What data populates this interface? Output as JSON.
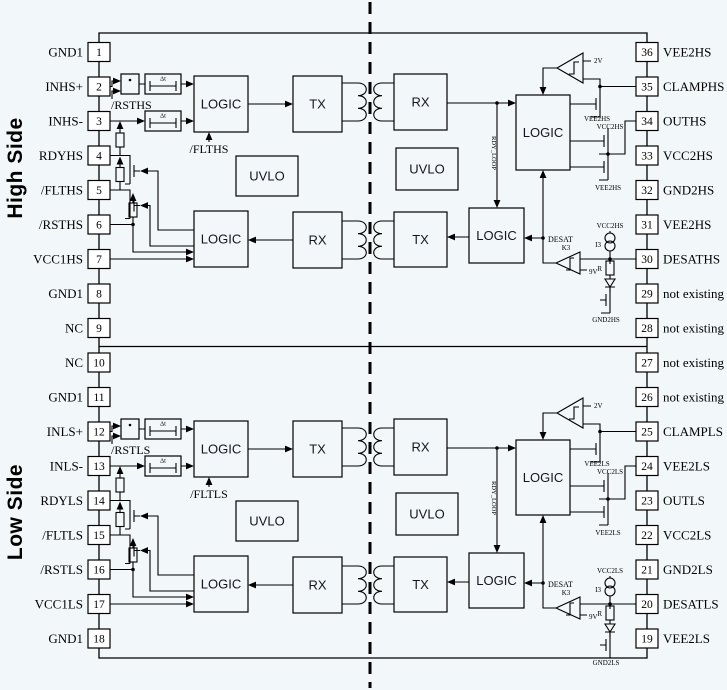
{
  "side_labels": {
    "high": "High Side",
    "low": "Low Side"
  },
  "pins_left": [
    {
      "num": "1",
      "label": "GND1"
    },
    {
      "num": "2",
      "label": "INHS+"
    },
    {
      "num": "3",
      "label": "INHS-"
    },
    {
      "num": "4",
      "label": "RDYHS"
    },
    {
      "num": "5",
      "label": "/FLTHS"
    },
    {
      "num": "6",
      "label": "/RSTHS"
    },
    {
      "num": "7",
      "label": "VCC1HS"
    },
    {
      "num": "8",
      "label": "GND1"
    },
    {
      "num": "9",
      "label": "NC"
    },
    {
      "num": "10",
      "label": "NC"
    },
    {
      "num": "11",
      "label": "GND1"
    },
    {
      "num": "12",
      "label": "INLS+"
    },
    {
      "num": "13",
      "label": "INLS-"
    },
    {
      "num": "14",
      "label": "RDYLS"
    },
    {
      "num": "15",
      "label": "/FLTLS"
    },
    {
      "num": "16",
      "label": "/RSTLS"
    },
    {
      "num": "17",
      "label": "VCC1LS"
    },
    {
      "num": "18",
      "label": "GND1"
    }
  ],
  "pins_right": [
    {
      "num": "36",
      "label": "VEE2HS"
    },
    {
      "num": "35",
      "label": "CLAMPHS"
    },
    {
      "num": "34",
      "label": "OUTHS"
    },
    {
      "num": "33",
      "label": "VCC2HS"
    },
    {
      "num": "32",
      "label": "GND2HS"
    },
    {
      "num": "31",
      "label": "VEE2HS"
    },
    {
      "num": "30",
      "label": "DESATHS"
    },
    {
      "num": "29",
      "label": "not existing"
    },
    {
      "num": "28",
      "label": "not existing"
    },
    {
      "num": "27",
      "label": "not existing"
    },
    {
      "num": "26",
      "label": "not existing"
    },
    {
      "num": "25",
      "label": "CLAMPLS"
    },
    {
      "num": "24",
      "label": "VEE2LS"
    },
    {
      "num": "23",
      "label": "OUTLS"
    },
    {
      "num": "22",
      "label": "VCC2LS"
    },
    {
      "num": "21",
      "label": "GND2LS"
    },
    {
      "num": "20",
      "label": "DESATLS"
    },
    {
      "num": "19",
      "label": "VEE2LS"
    }
  ],
  "halves": [
    {
      "name": "high-side",
      "blocks": {
        "logic_in": "LOGIC",
        "tx_top": "TX",
        "rx_top": "RX",
        "uvlo_left": "UVLO",
        "uvlo_right": "UVLO",
        "logic_fault": "LOGIC",
        "rx_bottom": "RX",
        "tx_bottom": "TX",
        "logic_mid": "LOGIC",
        "logic_out": "LOGIC"
      },
      "labels": {
        "rst": "/RSTHS",
        "flt": "/FLTHS",
        "dt": "Δt",
        "rdy_loop": "RDY_LOOP",
        "desat": "DESAT",
        "clamp_ref": "2V",
        "comp_name": "K3",
        "desat_ref": "9V",
        "current_source": "I3",
        "resistor": "R",
        "vee2_clamp": "VEE2HS",
        "vcc2_out": "VCC2HS",
        "vee2_out": "VEE2HS",
        "vcc2_desat": "VCC2HS",
        "gnd2": "GND2HS"
      }
    },
    {
      "name": "low-side",
      "blocks": {
        "logic_in": "LOGIC",
        "tx_top": "TX",
        "rx_top": "RX",
        "uvlo_left": "UVLO",
        "uvlo_right": "UVLO",
        "logic_fault": "LOGIC",
        "rx_bottom": "RX",
        "tx_bottom": "TX",
        "logic_mid": "LOGIC",
        "logic_out": "LOGIC"
      },
      "labels": {
        "rst": "/RSTLS",
        "flt": "/FLTLS",
        "dt": "Δt",
        "rdy_loop": "RDY_LOOP",
        "desat": "DESAT",
        "clamp_ref": "2V",
        "comp_name": "K3",
        "desat_ref": "9V",
        "current_source": "I3",
        "resistor": "R",
        "vee2_clamp": "VEE2LS",
        "vcc2_out": "VCC2LS",
        "vee2_out": "VEE2LS",
        "vcc2_desat": "VCC2LS",
        "gnd2": "GND2LS"
      }
    }
  ]
}
